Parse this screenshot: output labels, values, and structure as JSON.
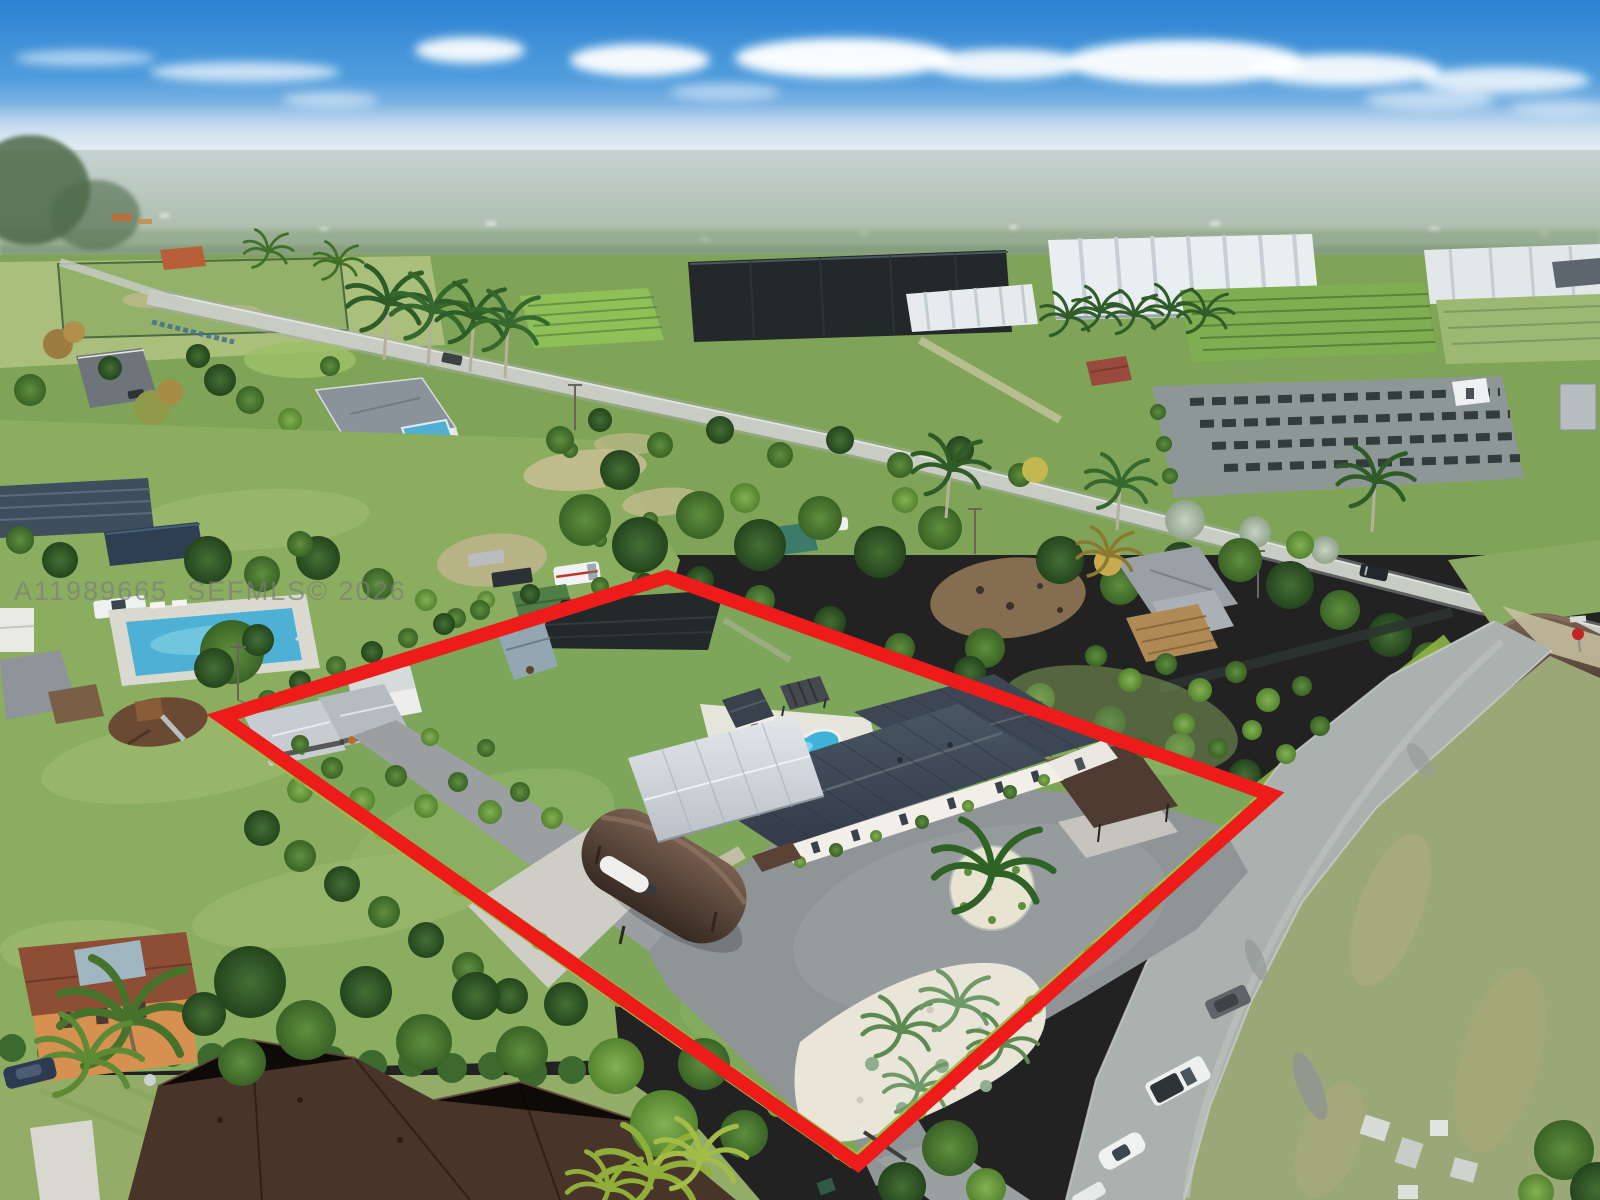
{
  "watermark": {
    "text": "A11989665  SEFMLS© 2026",
    "color": "#7d7d7d"
  },
  "boundary": {
    "shape": "quadrilateral lot outline overlay",
    "points": "222,717 667,577 1271,795 858,1164",
    "color": "#ed1c1a",
    "stroke_width": 14
  },
  "palette": {
    "sky_top": "#2b82d2",
    "sky_horizon": "#dde7ec",
    "haze": "#d9e2e4",
    "distant_land": "#a3b49c",
    "field_green": "#7fa457",
    "lawn": "#85aa5e",
    "asphalt": "#8f9496",
    "concrete_road": "#abb1ae",
    "driveway": "#9b9fa1",
    "house_roof_charcoal": "#3c4652",
    "silver_patio_roof": "#ccd3d8",
    "carport_brown": "#4e3b31",
    "quonset_brown": "#4a3a2e",
    "pool_water": "#3eb2d8",
    "pool_deck": "#e6e5dc",
    "white_gravel": "#e9e5d8",
    "hedge_lime": "#9dbf4b",
    "shade_cloth_black": "#23282b",
    "greenhouse_white": "#e9eef1",
    "boundary_red": "#ed1c1a",
    "stop_sign_red": "#c32424"
  },
  "scene": {
    "type": "aerial-drone-photograph",
    "features": [
      "blue-sky-with-cloud-band",
      "hazy-horizon",
      "distant-farmland",
      "greenhouse-complex",
      "black-shade-cloth-nurseries",
      "crop-row-fields",
      "east-west-road",
      "south-road-with-parked-cars",
      "t-junction-stop-sign",
      "red-outlined-subject-lot",
      "main-house-charcoal-metal-roof",
      "silver-patio-roof",
      "free-form-swimming-pool",
      "pool-house",
      "pergola",
      "outdoor-lounge-enclosure",
      "quonset-boat-carport",
      "flat-brown-carport",
      "metal-carports",
      "storage-shed",
      "shade-nursery-structure",
      "motor-court",
      "palm-island",
      "white-rock-garden",
      "perimeter-lime-hedges",
      "neighbor-lap-pool",
      "neighbor-playground",
      "neighbor-houses",
      "foreground-rooftops",
      "mls-watermark"
    ]
  },
  "vehicles": {
    "south_road": [
      "gray-suv",
      "white-pickup-black-tonneau",
      "white-sports-car",
      "white-car-partial"
    ],
    "north_of_lot": [
      "silver-truck",
      "dark-pickup",
      "white-van-red-stripe"
    ],
    "neighbors": [
      "white-pickup",
      "navy-sedan",
      "black-car-on-road",
      "white-car"
    ]
  }
}
